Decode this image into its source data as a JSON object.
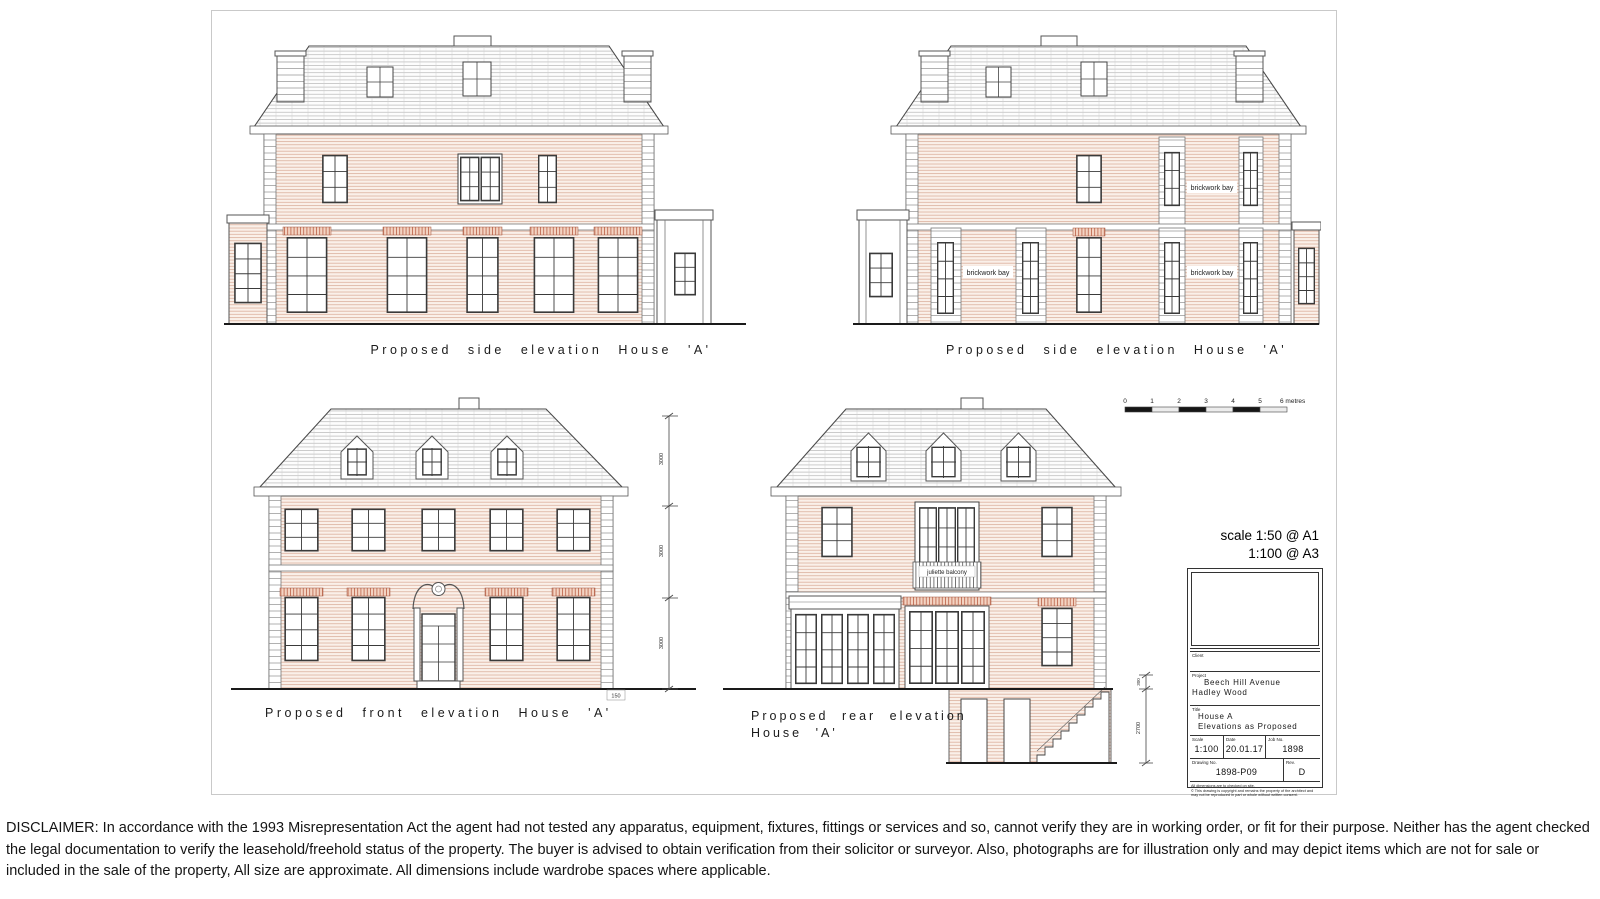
{
  "sheet": {
    "captions": {
      "top_left": "Proposed side elevation House 'A'",
      "top_right": "Proposed side elevation House 'A'",
      "front": "Proposed front elevation House 'A'",
      "rear_line1": "Proposed rear elevation",
      "rear_line2": "House 'A'"
    },
    "annotations": {
      "brickwork_bay": "brickwork bay",
      "juliette_balcony": "juliette balcony",
      "dim_3000": "3000",
      "dim_300": "300",
      "dim_2700": "2700",
      "dim_150": "150"
    },
    "scale_bar": {
      "ticks": [
        "0",
        "1",
        "2",
        "3",
        "4",
        "5"
      ],
      "end_label": "6 metres"
    },
    "scale_note": {
      "line1": "scale 1:50 @ A1",
      "line2": "1:100 @ A3"
    },
    "title_block": {
      "client_label": "Client",
      "project_label": "Project",
      "project_line1": "Beech Hill Avenue",
      "project_line2": "Hadley Wood",
      "title_label": "Title",
      "title_line1": "House A",
      "title_line2": "Elevations as Proposed",
      "scale_label": "Scale",
      "scale_value": "1:100",
      "date_label": "Date",
      "date_value": "20.01.17",
      "job_label": "Job No.",
      "job_value": "1898",
      "drawing_label": "Drawing No.",
      "drawing_value": "1898-P09",
      "rev_label": "Rev.",
      "rev_value": "D",
      "note_line1": "All dimensions are to checked on site.",
      "note_line2": "© This drawing is copyright and remains the property of the architect and may not be reproduced in part or whole without written consent."
    }
  },
  "disclaimer": "DISCLAIMER: In accordance with the 1993 Misrepresentation Act the agent had not tested any apparatus, equipment, fixtures, fittings or services and so, cannot verify they are in working order, or fit for their purpose. Neither has the agent checked the legal documentation to verify the leasehold/freehold status of the property. The buyer is advised to obtain verification from their solicitor or surveyor. Also, photographs are for illustration only and may depict items which are not for sale or included in the sale of the property, All size are approximate. All dimensions include wardrobe spaces where applicable."
}
